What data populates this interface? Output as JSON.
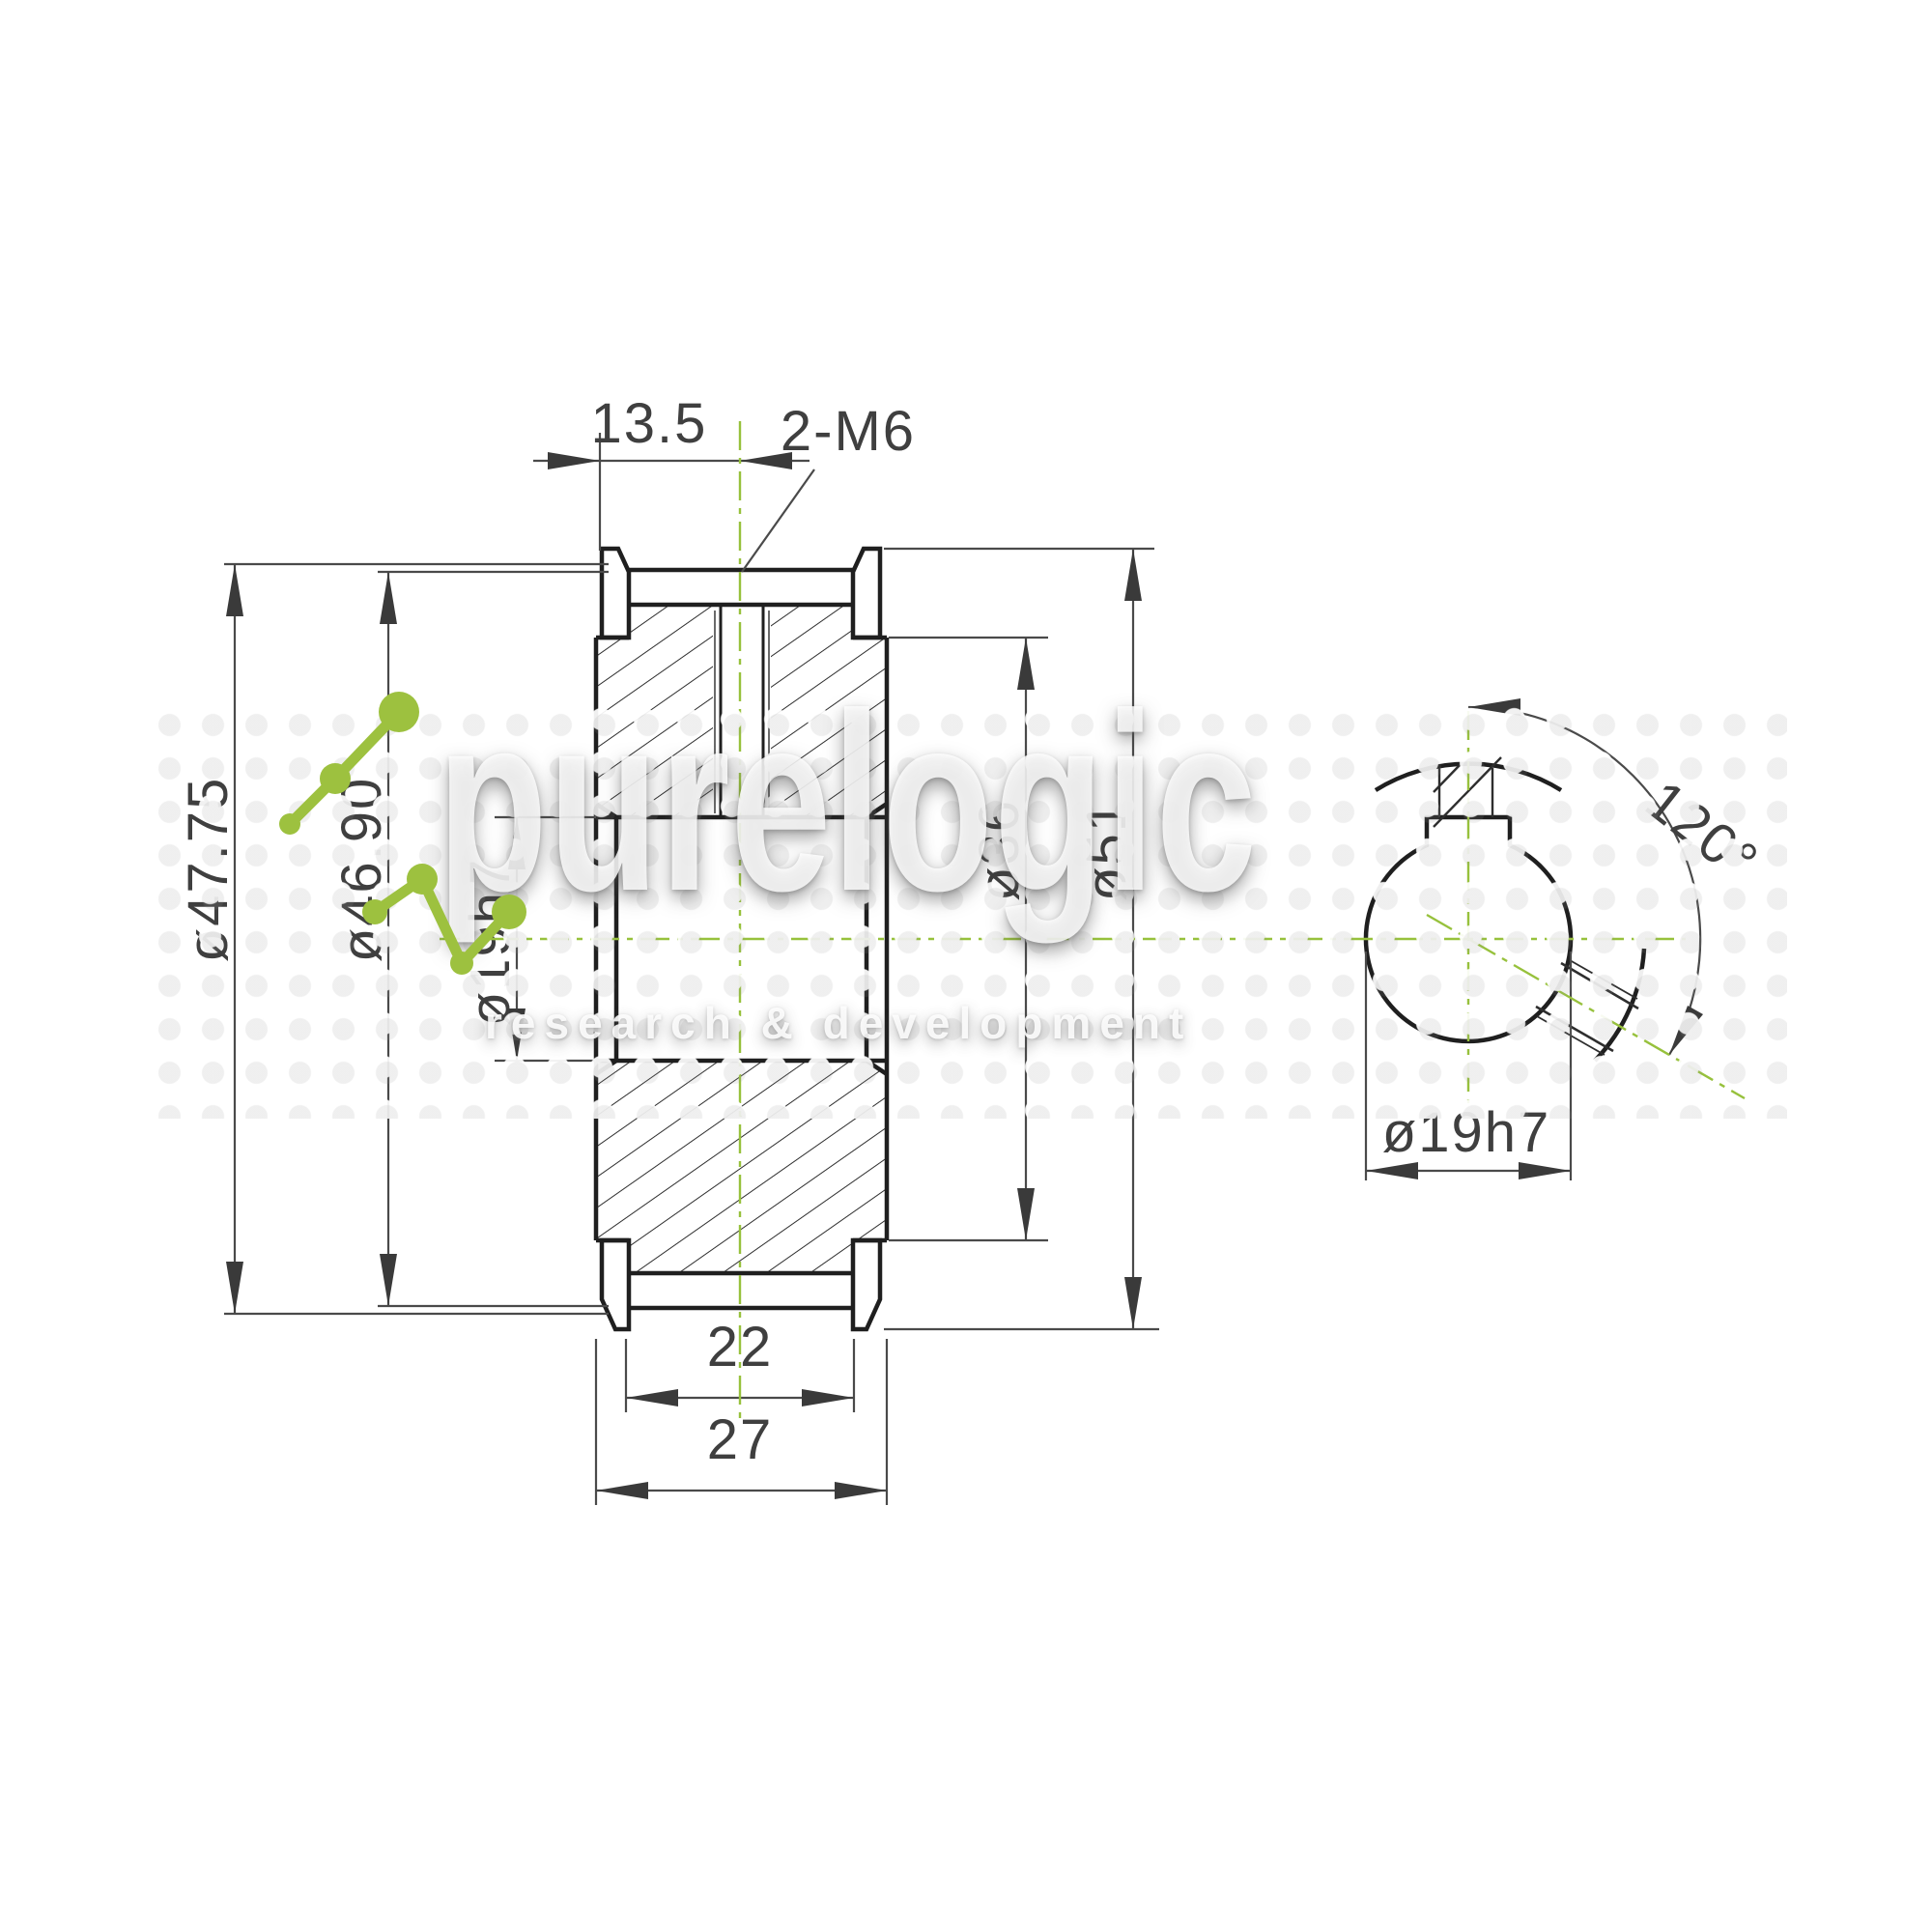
{
  "drawing": {
    "type": "engineering-drawing",
    "subject": "timing pulley cross-section and bore end view"
  },
  "dims": {
    "width_top": "13.5",
    "thread": "2-M6",
    "od_tip": "ø47.75",
    "od_pitch": "ø46.90",
    "bore_main": "ø19h7",
    "recess": "ø36",
    "od_flange": "ø51",
    "belt_width": "22",
    "overall_width": "27",
    "angle": "120°",
    "bore_end": "ø19h7"
  },
  "watermark": {
    "brand": "purelogic",
    "tagline": "research & development"
  },
  "colors": {
    "outline": "#1f1f1f",
    "dimension_lines": "#4a4a4a",
    "text": "#3f3f3f",
    "centerline_green": "#97c13c",
    "logo_green": "#9dc13f",
    "background": "#ffffff"
  }
}
